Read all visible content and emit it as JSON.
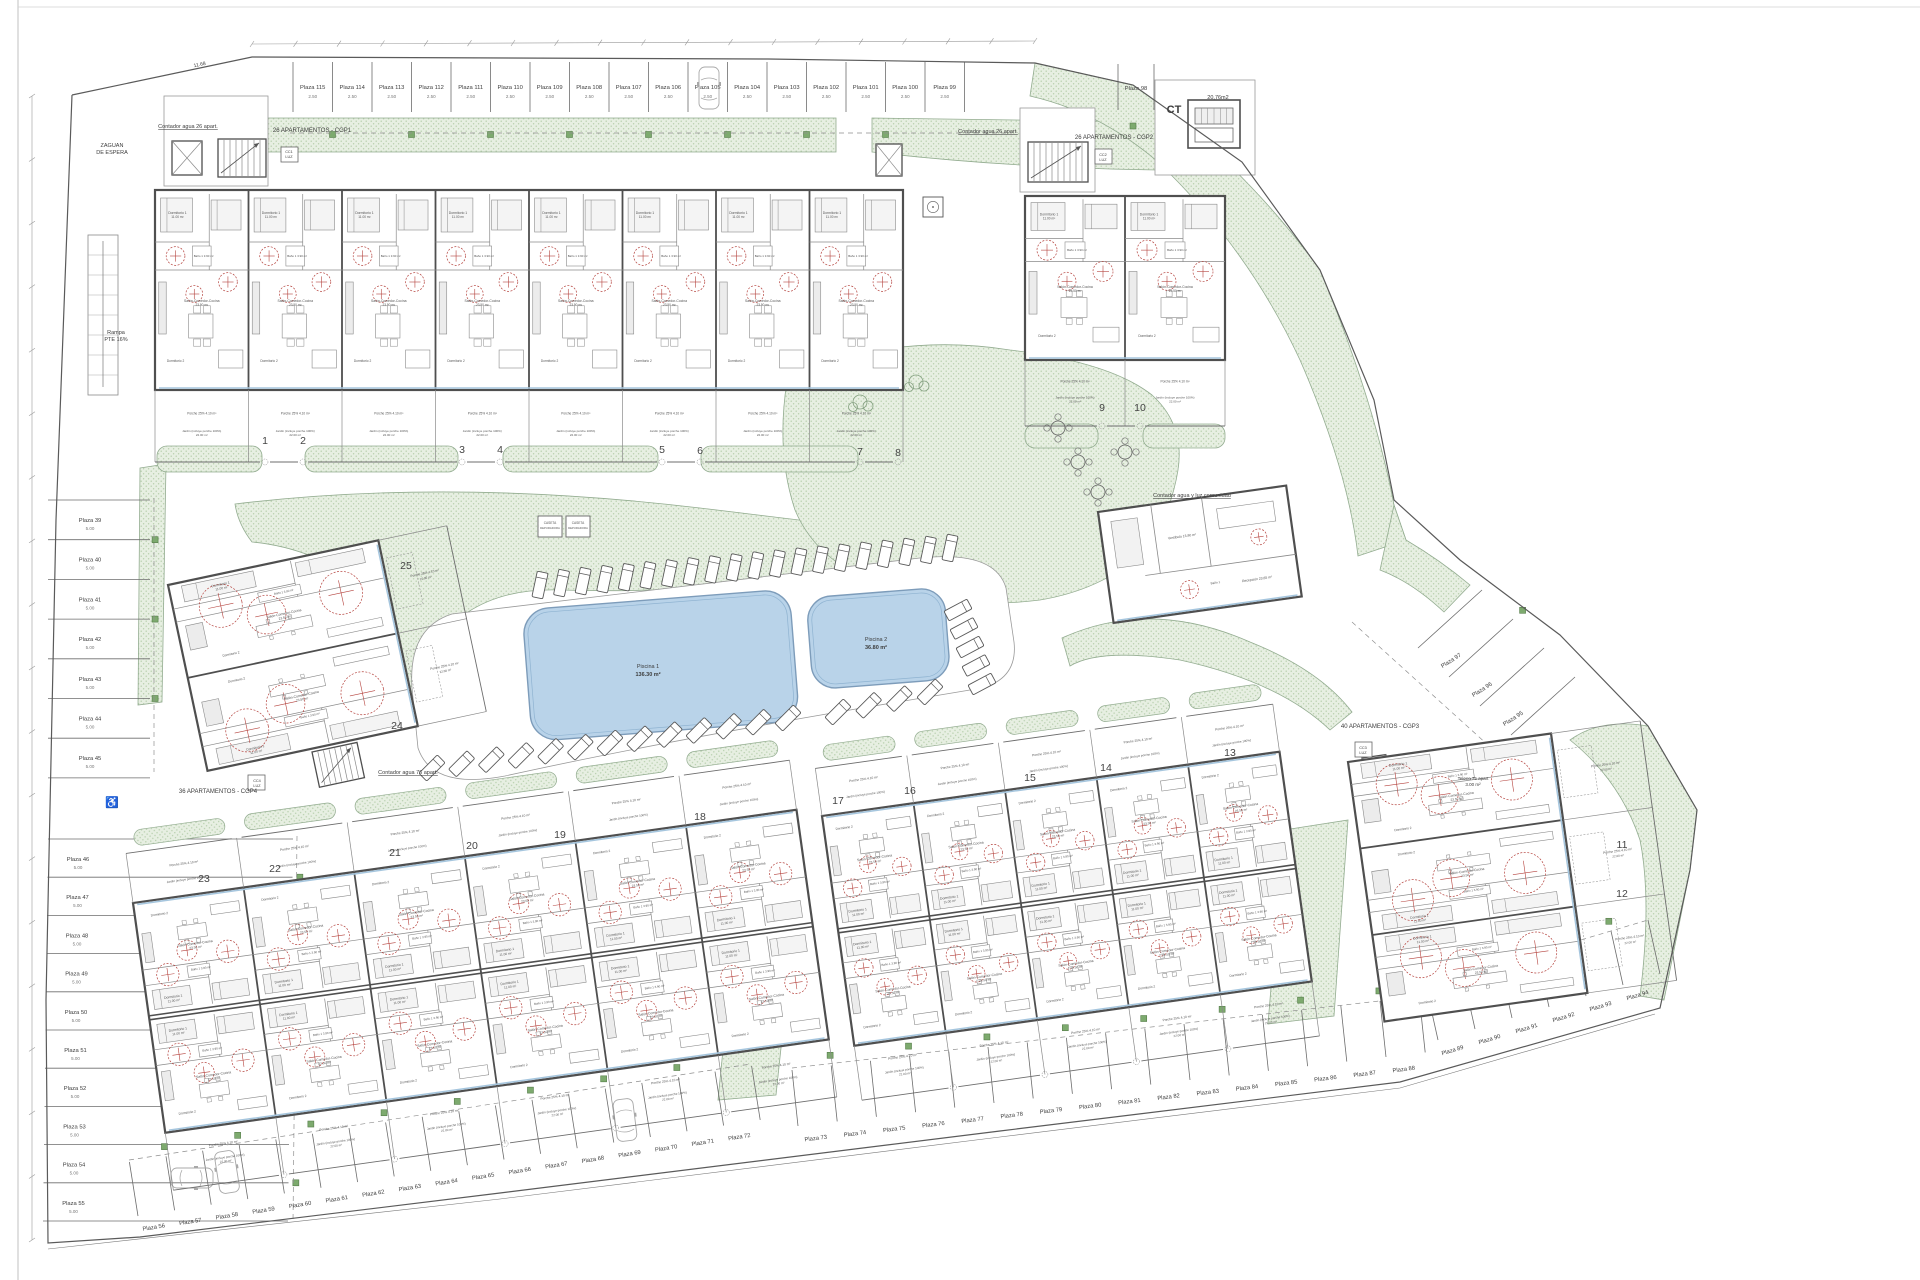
{
  "title": "Plano de conjunto - planta general",
  "palette": {
    "wall": "#4f4f4f",
    "thin": "#8a8a8a",
    "faint": "#b5b5b5",
    "green_fill": "#e7efe2",
    "green_dot": "#b4cdaa",
    "green_edge": "#93ac90",
    "green_sq": "#7daa6e",
    "green_sq_edge": "#567d4a",
    "pool_fill": "#b9d3e9",
    "pool_edge": "#7d9cba",
    "pool_inner": "#8fb3d1",
    "red": "#b5433e",
    "text": "#3c3c3c",
    "glass": "#a6c6de",
    "light": "#efefef",
    "deck_edge": "#9a9a9a"
  },
  "room_text": {
    "bedroom": "Dormitorio 1",
    "bedroom_area": "11.00 m²",
    "bedroom2": "Dormitorio 2",
    "bedroom2_area": "10.70 m²",
    "living": "Salón-Comedor-Cocina",
    "living_area": "23.50 m²",
    "bath": "Baño 1  3.90 m²",
    "porch": "Porche 25%  4.10 m²",
    "garden": "Jardín (incluye porche 100%)",
    "garden_area": "22.00 m²",
    "club_room1": "Vestíbulo  13.80 m²",
    "club_room2": "Recepción  23.65 m²",
    "club_room3": "Baño 1",
    "caseta_line1": "CASETA",
    "caseta_line2": "DEPURADORA"
  },
  "labels": [
    {
      "t": "ZAGUAN",
      "x": 112,
      "y": 147,
      "s": 5.5
    },
    {
      "t": "DE ESPERA",
      "x": 112,
      "y": 154,
      "s": 5.5
    },
    {
      "t": "Rampa",
      "x": 116,
      "y": 334,
      "s": 5.5
    },
    {
      "t": "PTE 16%",
      "x": 116,
      "y": 341,
      "s": 5.5
    },
    {
      "t": "Contador agua 26 apart.",
      "x": 188,
      "y": 128,
      "s": 5.5,
      "u": 1
    },
    {
      "t": "26 APARTAMENTOS - CGP1",
      "x": 312,
      "y": 132,
      "s": 6
    },
    {
      "t": "CC1",
      "x": 289,
      "y": 153,
      "s": 3.8
    },
    {
      "t": "LUZ",
      "x": 289,
      "y": 158,
      "s": 3.8
    },
    {
      "t": "Contador agua 26 apart.",
      "x": 988,
      "y": 133,
      "s": 5.5,
      "u": 1
    },
    {
      "t": "26 APARTAMENTOS - CGP2",
      "x": 1114,
      "y": 139,
      "s": 6
    },
    {
      "t": "CC2",
      "x": 1103,
      "y": 156,
      "s": 3.8
    },
    {
      "t": "LUZ",
      "x": 1103,
      "y": 161,
      "s": 3.8
    },
    {
      "t": "CT",
      "x": 1174,
      "y": 113,
      "s": 11,
      "b": 1
    },
    {
      "t": "20,76m2",
      "x": 1218,
      "y": 99,
      "s": 5.5
    },
    {
      "t": "Piscina 1",
      "x": 648,
      "y": 668,
      "s": 5.5
    },
    {
      "t": "136.30 m²",
      "x": 648,
      "y": 676,
      "s": 5.5,
      "b": 1
    },
    {
      "t": "Piscina 2",
      "x": 876,
      "y": 641,
      "s": 5.5
    },
    {
      "t": "36.80 m²",
      "x": 876,
      "y": 649,
      "s": 5.5,
      "b": 1
    },
    {
      "t": "Contador agua y luz comunidad",
      "x": 1192,
      "y": 497,
      "s": 5.5,
      "u": 1
    },
    {
      "t": "40 APARTAMENTOS - CGP3",
      "x": 1380,
      "y": 728,
      "s": 6
    },
    {
      "t": "CC3",
      "x": 1363,
      "y": 749,
      "s": 3.8
    },
    {
      "t": "LUZ",
      "x": 1363,
      "y": 754,
      "s": 3.8
    },
    {
      "t": "Teleco 75 apart",
      "x": 1473,
      "y": 780,
      "s": 4.5
    },
    {
      "t": "3.00 m²",
      "x": 1473,
      "y": 786,
      "s": 4.5
    },
    {
      "t": "36 APARTAMENTOS - CGP4",
      "x": 218,
      "y": 793,
      "s": 6
    },
    {
      "t": "CC4",
      "x": 257,
      "y": 782,
      "s": 3.8
    },
    {
      "t": "LUZ",
      "x": 257,
      "y": 787,
      "s": 3.8
    },
    {
      "t": "Contador agua 76 apart.",
      "x": 408,
      "y": 774,
      "s": 5.5,
      "u": 1
    },
    {
      "t": "11.68",
      "x": 200,
      "y": 66,
      "s": 5,
      "rot": -12
    }
  ],
  "unit_numbers": [
    {
      "n": "1",
      "x": 265,
      "y": 444
    },
    {
      "n": "2",
      "x": 303,
      "y": 444
    },
    {
      "n": "3",
      "x": 462,
      "y": 453
    },
    {
      "n": "4",
      "x": 500,
      "y": 453
    },
    {
      "n": "5",
      "x": 662,
      "y": 453
    },
    {
      "n": "6",
      "x": 700,
      "y": 454
    },
    {
      "n": "7",
      "x": 860,
      "y": 455
    },
    {
      "n": "8",
      "x": 898,
      "y": 456
    },
    {
      "n": "9",
      "x": 1102,
      "y": 411
    },
    {
      "n": "10",
      "x": 1140,
      "y": 411
    },
    {
      "n": "11",
      "x": 1622,
      "y": 848
    },
    {
      "n": "12",
      "x": 1622,
      "y": 897
    },
    {
      "n": "13",
      "x": 1230,
      "y": 756
    },
    {
      "n": "14",
      "x": 1106,
      "y": 771
    },
    {
      "n": "15",
      "x": 1030,
      "y": 781
    },
    {
      "n": "16",
      "x": 910,
      "y": 794
    },
    {
      "n": "17",
      "x": 838,
      "y": 804
    },
    {
      "n": "18",
      "x": 700,
      "y": 820
    },
    {
      "n": "19",
      "x": 560,
      "y": 838
    },
    {
      "n": "20",
      "x": 472,
      "y": 849
    },
    {
      "n": "21",
      "x": 395,
      "y": 856
    },
    {
      "n": "22",
      "x": 275,
      "y": 872
    },
    {
      "n": "23",
      "x": 204,
      "y": 882
    },
    {
      "n": "24",
      "x": 397,
      "y": 729
    },
    {
      "n": "25",
      "x": 406,
      "y": 569
    }
  ],
  "parking": {
    "plaza_prefix": "Plaza",
    "rows": [
      {
        "id": "top",
        "from": 115,
        "to": 99,
        "start": [
          293,
          62
        ],
        "step": [
          39.5,
          0
        ],
        "sv": [
          0,
          50
        ],
        "off": [
          19.7,
          27
        ],
        "rot": 0,
        "dim": "2.50",
        "dimoff": [
          19.7,
          36
        ],
        "dash": [
          290,
          133,
          1012,
          133
        ],
        "gmul": 1.45
      },
      {
        "id": "left-a",
        "from": 39,
        "to": 45,
        "start": [
          48,
          500
        ],
        "step": [
          0,
          39.7
        ],
        "sv": [
          102,
          0
        ],
        "off": [
          42,
          22
        ],
        "rot": 0,
        "dim": "5.00",
        "dimoff": [
          42,
          30
        ],
        "dash": [
          154,
          498,
          154,
          772
        ],
        "gmul": 1.05
      },
      {
        "id": "left-b",
        "from": 46,
        "to": 55,
        "start": [
          48,
          839
        ],
        "step": [
          -0.5,
          38.2
        ],
        "sv": [
          245,
          0
        ],
        "off": [
          30,
          22
        ],
        "rot": 0,
        "dim": "5.00",
        "dimoff": [
          30,
          30
        ],
        "dash": [
          297,
          836,
          293,
          1222
        ],
        "gm": 1.03,
        "gmul": 1.03
      },
      {
        "id": "bottom-1",
        "from": 56,
        "to": 72,
        "start": [
          138,
          1216
        ],
        "step": [
          36.6,
          -5.65
        ],
        "sv": [
          -8.6,
          -54
        ],
        "off": [
          16,
          13
        ],
        "rot": -9,
        "dash": [
          129,
          1160,
          751,
          1064
        ],
        "gmul": 1.18
      },
      {
        "id": "bottom-2",
        "from": 73,
        "to": 88,
        "start": [
          798,
          1126
        ],
        "step": [
          39.2,
          -4.6
        ],
        "sv": [
          -6,
          -56
        ],
        "off": [
          18,
          14
        ],
        "rot": -7,
        "dash": [
          792,
          1068,
          1458,
          992
        ],
        "gmul": 1.18
      },
      {
        "id": "bottom-3",
        "from": 89,
        "to": 94,
        "start": [
          1438,
          1040
        ],
        "step": [
          37,
          -11
        ],
        "sv": [
          -12,
          -54
        ],
        "off": [
          15,
          12
        ],
        "rot": -17,
        "dash": [
          1426,
          986,
          1648,
          920
        ],
        "gmul": 1.18
      },
      {
        "id": "right-slant",
        "from": 97,
        "to": 95,
        "start": [
          1418,
          648
        ],
        "step": [
          31,
          29
        ],
        "sv": [
          64,
          -58
        ],
        "off": [
          34,
          14
        ],
        "rot": -33,
        "dash": [
          1352,
          622,
          1562,
          812
        ],
        "gmul": 1.15
      }
    ],
    "isolated": {
      "label": "Plaza 98",
      "lines": [
        [
          1118,
          64,
          1118,
          110
        ],
        [
          1154,
          64,
          1154,
          110
        ]
      ],
      "label_pos": [
        1136,
        90
      ],
      "green": [
        1133,
        126
      ]
    },
    "disabled_pos": [
      112,
      806
    ]
  },
  "cars": [
    {
      "x": 709,
      "y": 88,
      "rot": 0
    },
    {
      "x": 208,
      "y": 921,
      "rot": 90
    },
    {
      "x": 208,
      "y": 959,
      "rot": 90
    },
    {
      "x": 192,
      "y": 1178,
      "rot": 90
    },
    {
      "x": 227,
      "y": 1172,
      "rot": -9
    },
    {
      "x": 625,
      "y": 1120,
      "rot": -7
    }
  ],
  "boundary": {
    "outer": [
      [
        72,
        95
      ],
      [
        252,
        57
      ],
      [
        768,
        59
      ],
      [
        1035,
        63
      ],
      [
        1133,
        85
      ],
      [
        1242,
        162
      ],
      [
        1320,
        270
      ],
      [
        1374,
        400
      ],
      [
        1394,
        500
      ],
      [
        1460,
        560
      ],
      [
        1560,
        635
      ],
      [
        1648,
        726
      ],
      [
        1697,
        810
      ],
      [
        1690,
        870
      ],
      [
        1660,
        1008
      ],
      [
        1400,
        1082
      ],
      [
        1000,
        1131
      ],
      [
        500,
        1193
      ],
      [
        140,
        1237
      ],
      [
        48,
        1243
      ],
      [
        46,
        1000
      ],
      [
        56,
        520
      ],
      [
        72,
        95
      ]
    ],
    "inner_bottom": [
      [
        48,
        1249
      ],
      [
        500,
        1199
      ],
      [
        1000,
        1137
      ],
      [
        1400,
        1088
      ],
      [
        1655,
        1014
      ]
    ]
  },
  "greens": {
    "paths": [
      "M252,118 L836,118 L836,152 L252,152 Q240,135 252,118 Z",
      "M872,118 L1158,122 L1158,170 Q1010,168 872,152 Z",
      "M1035,63 L1133,85 Q1242,162 1320,270 Q1374,400 1394,505 L1406,540 L1358,556 Q1348,470 1300,360 Q1248,248 1158,162 Q1100,112 1030,96 Z",
      "M1648,726 L1697,810 L1690,870 L1664,1000 L1640,996 Q1652,900 1640,840 Q1620,780 1570,740 Q1600,718 1648,726 Z",
      "M1394,505 L1406,540 Q1440,560 1470,585 L1444,612 Q1412,582 1380,570 Z",
      "M235,504 Q450,478 700,508 Q900,532 1062,553 L1062,582 Q940,560 850,574 Q700,594 560,590 Q505,588 468,612 Q440,630 432,668 L430,700 L406,702 Q402,622 362,586 Q315,548 252,542 Q238,524 235,504 Z",
      "M788,375 Q900,332 1010,350 Q1110,362 1152,395 Q1185,425 1178,470 Q1170,520 1140,555 Q1100,590 1040,600 Q960,610 900,590 Q820,570 795,510 Q775,450 788,375 Z",
      "M742,858 L802,850 L776,1095 L718,1100 Z",
      "M1284,830 L1348,820 L1334,1016 L1268,1024 Z",
      "M1062,638 Q1150,598 1250,642 Q1320,670 1352,712 L1330,730 Q1280,682 1180,660 Q1100,648 1070,666 Z",
      "M140,468 L166,464 L162,702 L138,705 Z"
    ],
    "scallop_rects": [
      [
        157,
        446,
        105,
        26
      ],
      [
        305,
        446,
        153,
        26
      ],
      [
        503,
        446,
        155,
        26
      ],
      [
        701,
        446,
        157,
        26
      ],
      [
        1025,
        424,
        73,
        24
      ],
      [
        1143,
        424,
        82,
        24
      ]
    ]
  },
  "deck_path": "M412,688 Q408,628 452,614 L920,558 Q995,550 1006,588 L1014,642 Q1018,678 982,688 L850,710 Q650,744 505,776 Q432,790 418,748 Z",
  "pools": [
    {
      "name": "pool-1",
      "x": 522,
      "y": 610,
      "rot": -4.5,
      "w": 268,
      "h": 132,
      "rx": 26
    },
    {
      "name": "pool-2",
      "x": 806,
      "y": 598,
      "rot": -4.5,
      "w": 138,
      "h": 92,
      "rx": 24
    }
  ],
  "loungers": {
    "top_row": {
      "n": 20,
      "x1": 540,
      "y1": 585,
      "x2": 950,
      "y2": 548,
      "rot": 12
    },
    "diag_row1": {
      "n": 13,
      "x1": 432,
      "y1": 768,
      "x2": 788,
      "y2": 718,
      "rot": 45
    },
    "diag_row2": {
      "n": 4,
      "x1": 838,
      "y1": 712,
      "x2": 930,
      "y2": 692,
      "rot": 45
    },
    "side_col": {
      "n": 5,
      "x1": 958,
      "y1": 610,
      "x2": 982,
      "y2": 684,
      "rot": 62
    }
  },
  "buildings": [
    {
      "id": "a",
      "type": "row",
      "x": 155,
      "y": 190,
      "rot": 0,
      "w": 748,
      "h": 200,
      "units": 8,
      "gh": 72,
      "gates": [
        110,
        148,
        307,
        345,
        507,
        545,
        705,
        743
      ]
    },
    {
      "id": "b",
      "type": "row",
      "x": 1025,
      "y": 196,
      "rot": 0,
      "w": 200,
      "h": 164,
      "units": 2,
      "gh": 66,
      "gates": [
        77,
        115
      ]
    },
    {
      "id": "c",
      "type": "side",
      "x": 168,
      "y": 585,
      "rot": -12,
      "w": 215,
      "h": 190,
      "rows": 2,
      "gw": 70
    },
    {
      "id": "d",
      "type": "double",
      "x": 133,
      "y": 903,
      "rot": -8,
      "w": 670,
      "h": 232,
      "cols": 6,
      "gt": 50,
      "gb": 58
    },
    {
      "id": "e",
      "type": "double",
      "x": 822,
      "y": 816,
      "rot": -8,
      "w": 462,
      "h": 232,
      "cols": 5,
      "gt": 48,
      "gb": 55
    },
    {
      "id": "f",
      "type": "side",
      "x": 1348,
      "y": 762,
      "rot": -8,
      "w": 205,
      "h": 262,
      "rows": 3,
      "gw": 90
    },
    {
      "id": "club",
      "type": "club",
      "x": 1098,
      "y": 512,
      "rot": -8,
      "w": 190,
      "h": 112
    }
  ],
  "stairs": [
    {
      "x": 218,
      "y": 139,
      "w": 48,
      "h": 38,
      "rot": 0
    },
    {
      "x": 1028,
      "y": 142,
      "w": 60,
      "h": 40,
      "rot": 0
    },
    {
      "x": 312,
      "y": 752,
      "w": 46,
      "h": 36,
      "rot": -12
    },
    {
      "x": 1390,
      "y": 756,
      "w": 68,
      "h": 44,
      "rot": -8
    }
  ],
  "elevators": [
    {
      "x": 172,
      "y": 141,
      "w": 30,
      "h": 34,
      "rot": 0
    },
    {
      "x": 876,
      "y": 144,
      "w": 26,
      "h": 32,
      "rot": 0
    },
    {
      "x": 1362,
      "y": 758,
      "w": 24,
      "h": 26,
      "rot": -8
    }
  ],
  "courts": [
    [
      164,
      96,
      104,
      90
    ],
    [
      1020,
      108,
      75,
      84
    ],
    [
      1155,
      80,
      100,
      95
    ]
  ],
  "ct": {
    "box": [
      1188,
      100,
      52,
      48
    ],
    "eq1": [
      1195,
      108,
      38,
      16
    ],
    "eq2": [
      1195,
      128,
      38,
      14
    ]
  },
  "utility_boxes": [
    {
      "x": 1133,
      "y": 196,
      "w": 18,
      "h": 18,
      "kind": "x"
    },
    {
      "x": 923,
      "y": 197,
      "w": 20,
      "h": 20,
      "kind": "o"
    }
  ],
  "casetas": [
    [
      538,
      516,
      24,
      21
    ],
    [
      566,
      516,
      24,
      21
    ]
  ],
  "ramp": [
    88,
    235,
    30,
    160
  ],
  "tables": [
    [
      1078,
      462
    ],
    [
      1125,
      452
    ],
    [
      1098,
      492
    ],
    [
      1058,
      428
    ]
  ],
  "bushes": [
    [
      880,
      372
    ],
    [
      916,
      382
    ],
    [
      860,
      402
    ]
  ],
  "dims": {
    "top_line": [
      252,
      44,
      1035,
      41
    ],
    "top_ticks": 18,
    "left_line": [
      32,
      96,
      32,
      1240
    ],
    "left_ticks": 18
  },
  "frame": {
    "left_x": 18,
    "top_y": 7
  }
}
